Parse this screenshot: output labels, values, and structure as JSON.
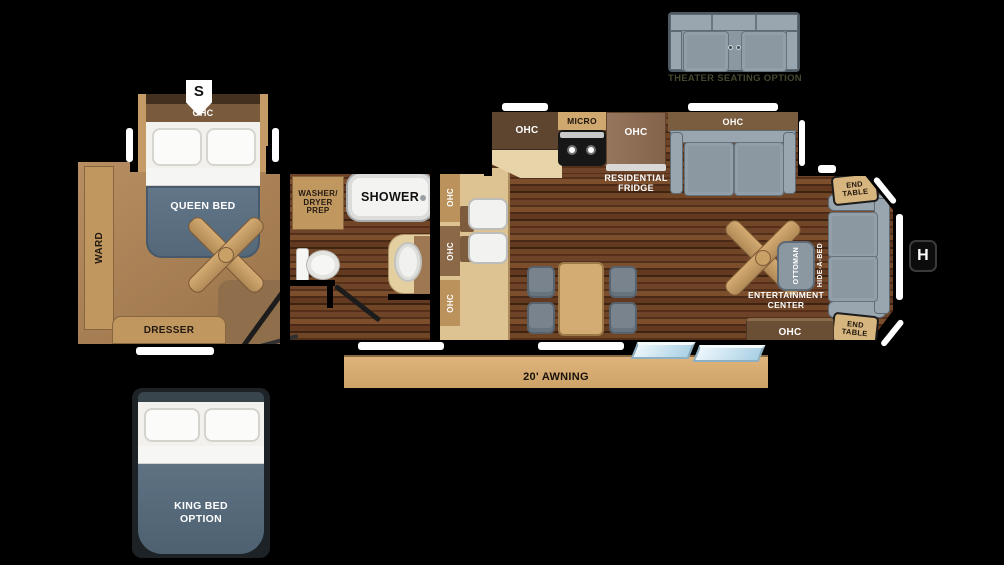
{
  "plan_type": "rv-travel-trailer-floor-plan",
  "labels": {
    "ohc": "OHC",
    "micro": "MICRO",
    "shower": "SHOWER",
    "washer_dryer_prep": "WASHER/\nDRYER\nPREP",
    "residential_fridge": "RESIDENTIAL\nFRIDGE",
    "queen_bed": "QUEEN BED",
    "ward": "WARD",
    "dresser": "DRESSER",
    "end_table": "END\nTABLE",
    "hide_a_bed": "HIDE-A-BED",
    "ottoman": "OTTOMAN",
    "entertainment_center": "ENTERTAINMENT\nCENTER",
    "awning": "20' AWNING",
    "theater_seating_option": "THEATER SEATING OPTION",
    "king_bed_option": "KING BED\nOPTION"
  },
  "markers": {
    "slide": "S",
    "hitch": "H"
  },
  "colors": {
    "background": "#000000",
    "wood_floor": "#5d3a22",
    "carpet_tan": "#ab8258",
    "cabinet_tan": "#c19760",
    "counter_tan": "#ddc292",
    "awning_tan": "#d8ae74",
    "bed_slate": "#5d7384",
    "sofa_gray": "#8b98a2",
    "step_glass": "#bfdfee"
  }
}
